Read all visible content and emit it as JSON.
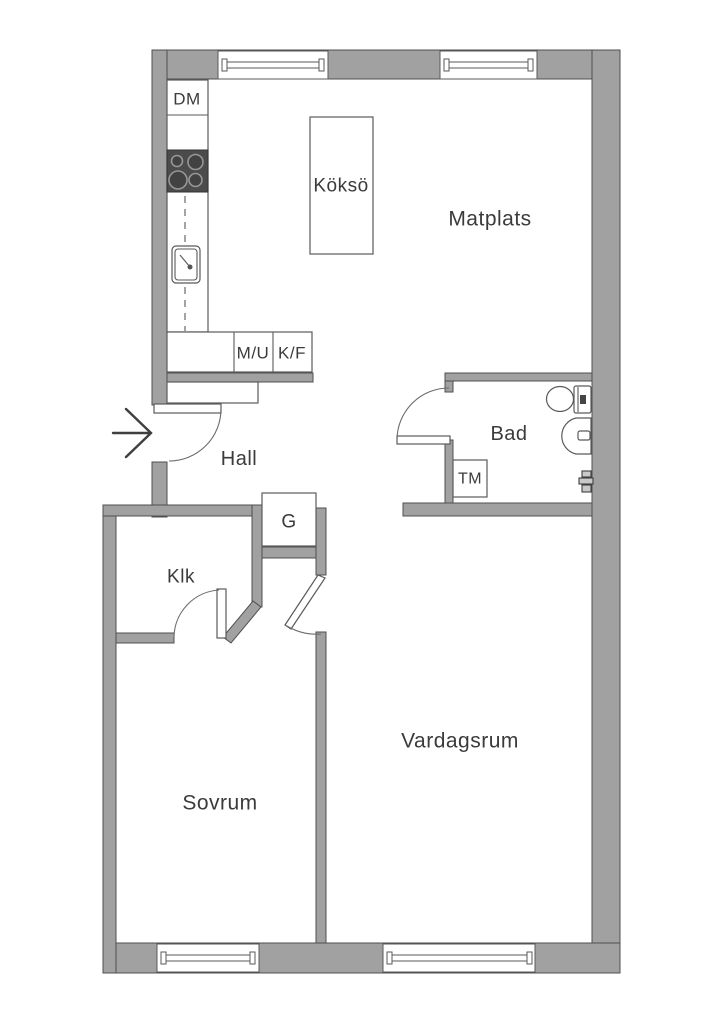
{
  "floorplan": {
    "rooms": {
      "matplats": "Matplats",
      "hall": "Hall",
      "bad": "Bad",
      "klk": "Klk",
      "sovrum": "Sovrum",
      "vardagsrum": "Vardagsrum"
    },
    "kitchen": {
      "dishwasher": "DM",
      "island": "Köksö",
      "micro_oven": "M/U",
      "fridge_freezer": "K/F"
    },
    "closets": {
      "wardrobe": "G"
    },
    "laundry": {
      "washing_machine": "TM"
    }
  },
  "colors": {
    "wall": "#a1a1a1",
    "wall_outline": "#4f4f4f",
    "line": "#5a5a5a",
    "text": "#3b3b3b",
    "background": "#ffffff",
    "stove": "#4b4b4b"
  }
}
